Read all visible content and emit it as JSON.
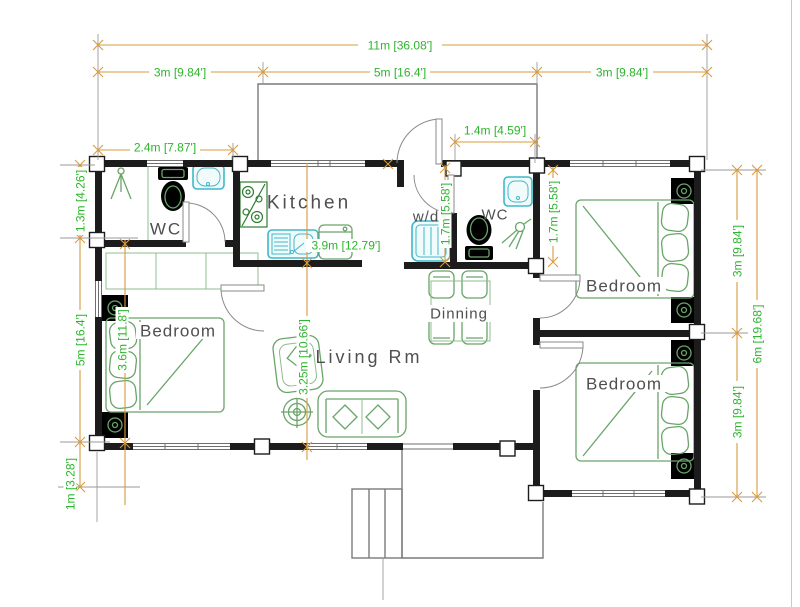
{
  "plan": {
    "dimensions": {
      "top_total": "11m [36.08']",
      "top_left": "3m [9.84']",
      "top_center": "5m [16.4']",
      "top_right": "3m [9.84']",
      "wc_width": "2.4m [7.87']",
      "entry_width": "1.4m [4.59']",
      "left_top": "1.3m [4.26']",
      "left_mid": "5m [16.4']",
      "left_bottom": "1m [3.28']",
      "right_top": "3m [9.84']",
      "right_bottom": "3m [9.84']",
      "right_total": "6m [19.68']",
      "kitchen_depth": "3.9m [12.79']",
      "living_depth": "3.25m [10.66']",
      "bedroom_left_width": "3.6m [11.8']",
      "utility_left_depth": "1.7m [5.58']",
      "utility_right_depth": "1.7m [5.58']"
    },
    "rooms": {
      "wc_left": "WC",
      "kitchen": "Kitchen",
      "laundry": "w/d",
      "wc_right": "WC",
      "bedroom_left": "Bedroom",
      "bedroom_top_right": "Bedroom",
      "bedroom_bottom_right": "Bedroom",
      "living": "Living Rm",
      "dining": "Dinning"
    },
    "colors": {
      "wall": "#1c1c1c",
      "dimension_line": "#d79b3f",
      "dimension_text": "#2db52d",
      "furniture": "#69a569",
      "fixture": "#3fb8c9",
      "room_label": "#4f4f4f"
    }
  }
}
